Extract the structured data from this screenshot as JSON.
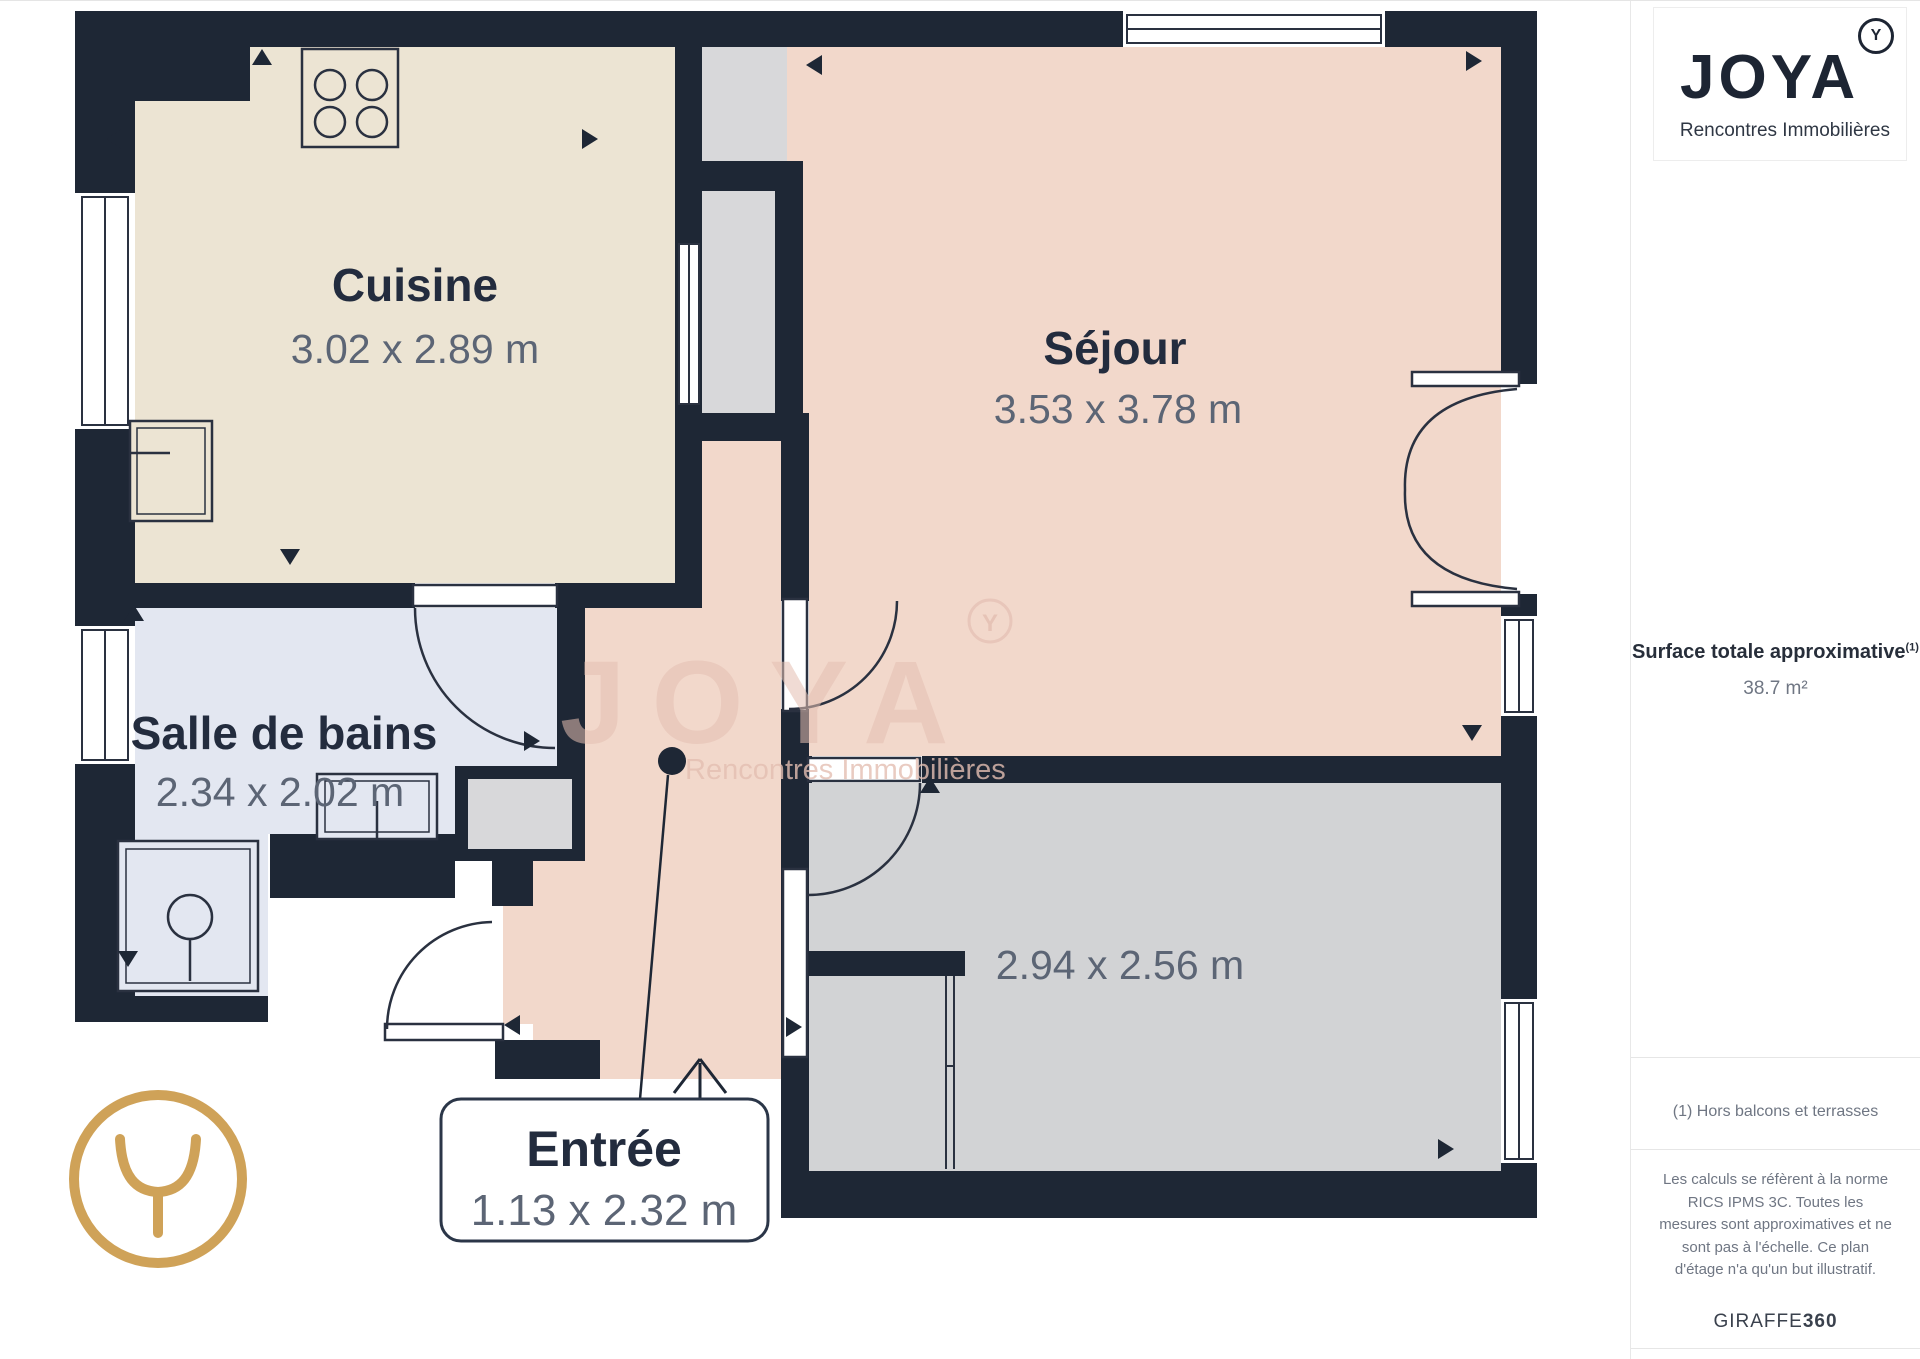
{
  "plan": {
    "rooms": {
      "cuisine": {
        "name": "Cuisine",
        "dimensions": "3.02 x 2.89 m"
      },
      "sejour": {
        "name": "Séjour",
        "dimensions": "3.53 x 3.78 m"
      },
      "salle_de_bains": {
        "name": "Salle de bains",
        "dimensions": "2.34 x 2.02 m"
      },
      "entree": {
        "name": "Entrée",
        "dimensions": "1.13 x 2.32 m"
      },
      "chambre": {
        "dimensions": "2.94 x 2.56 m"
      }
    },
    "watermark": {
      "wordmark": "JOYA",
      "tagline": "Rencontres Immobilières",
      "monogram": "Y"
    }
  },
  "sidebar": {
    "logo": {
      "wordmark": "JOYA",
      "tagline": "Rencontres Immobilières",
      "monogram": "Y"
    },
    "surface": {
      "label": "Surface totale approximative",
      "footnote_marker": "(1)",
      "value": "38.7 m²"
    },
    "note": "(1) Hors balcons et terrasses",
    "legal": "Les calculs se réfèrent à la norme RICS IPMS 3C. Toutes les mesures sont approximatives et ne sont pas à l'échelle. Ce plan d'étage n'a qu'un but illustratif.",
    "brand": {
      "name": "GIRAFFE",
      "suffix": "360"
    }
  },
  "icons": {
    "camera_arrow": "filled-triangle-camera-position",
    "entrance_arrow": "open-arrow-up-entrance",
    "joya_monogram": "Y-in-circle",
    "stove": "four-burner-hob",
    "shower": "shower-tray-with-drain",
    "sink": "washbasin",
    "door_arc": "door-swing-arc",
    "window": "double-line-window"
  },
  "colors": {
    "wall": "#1e2735",
    "floor_cuisine": "#ece4d3",
    "floor_sejour": "#f2d8cb",
    "floor_salle_de_bains": "#e3e7f1",
    "floor_chambre": "#d2d3d5",
    "floor_shaft": "#d8d8da",
    "accent_gold": "#cfa258",
    "watermark": "#e4bfb2",
    "text_dark": "#232c3e",
    "text_dim": "#5c6575"
  }
}
